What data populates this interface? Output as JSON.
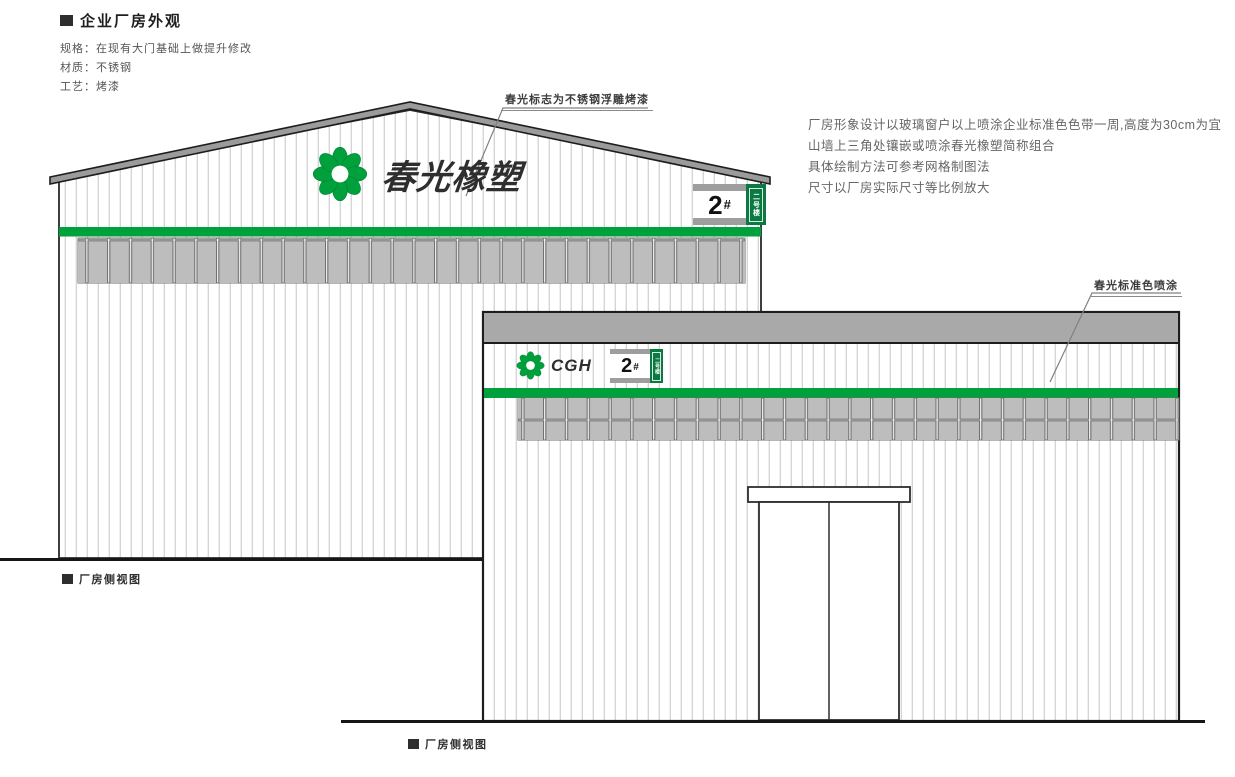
{
  "header": {
    "marker": "■",
    "title": "企业厂房外观",
    "specs": [
      "规格：在现有大门基础上做提升修改",
      "材质：不锈钢",
      "工艺：烤漆"
    ]
  },
  "notes": {
    "lines": [
      "厂房形象设计以玻璃窗户以上喷涂企业标准色色带一周,高度为30cm为宜",
      "山墙上三角处镶嵌或喷涂春光橡塑简称组合",
      "具体绘制方法可参考网格制图法",
      "尺寸以厂房实际尺寸等比例放大"
    ]
  },
  "annotations": {
    "logo_note": "春光标志为不锈钢浮雕烤漆",
    "color_note": "春光标准色喷涂"
  },
  "left_building": {
    "logo_text": "春光橡塑",
    "sign": {
      "number": "2",
      "hash": "#",
      "vertical_label": "二号楼"
    },
    "caption_marker": "■",
    "caption": "厂房侧视图"
  },
  "right_building": {
    "logo_text": "CGH",
    "sign": {
      "number": "2",
      "hash": "#",
      "vertical_label": "二号楼"
    },
    "caption_marker": "■",
    "caption": "厂房侧视图"
  },
  "colors": {
    "brand_green": "#00A03C",
    "sign_green": "#0B7A42",
    "roof_gray": "#9B9B9B",
    "parapet_gray": "#A9A9A9",
    "slat_gray": "#BDBDBD",
    "outline": "#1D1D1D",
    "logo_text_color": "#2E2E2E"
  }
}
